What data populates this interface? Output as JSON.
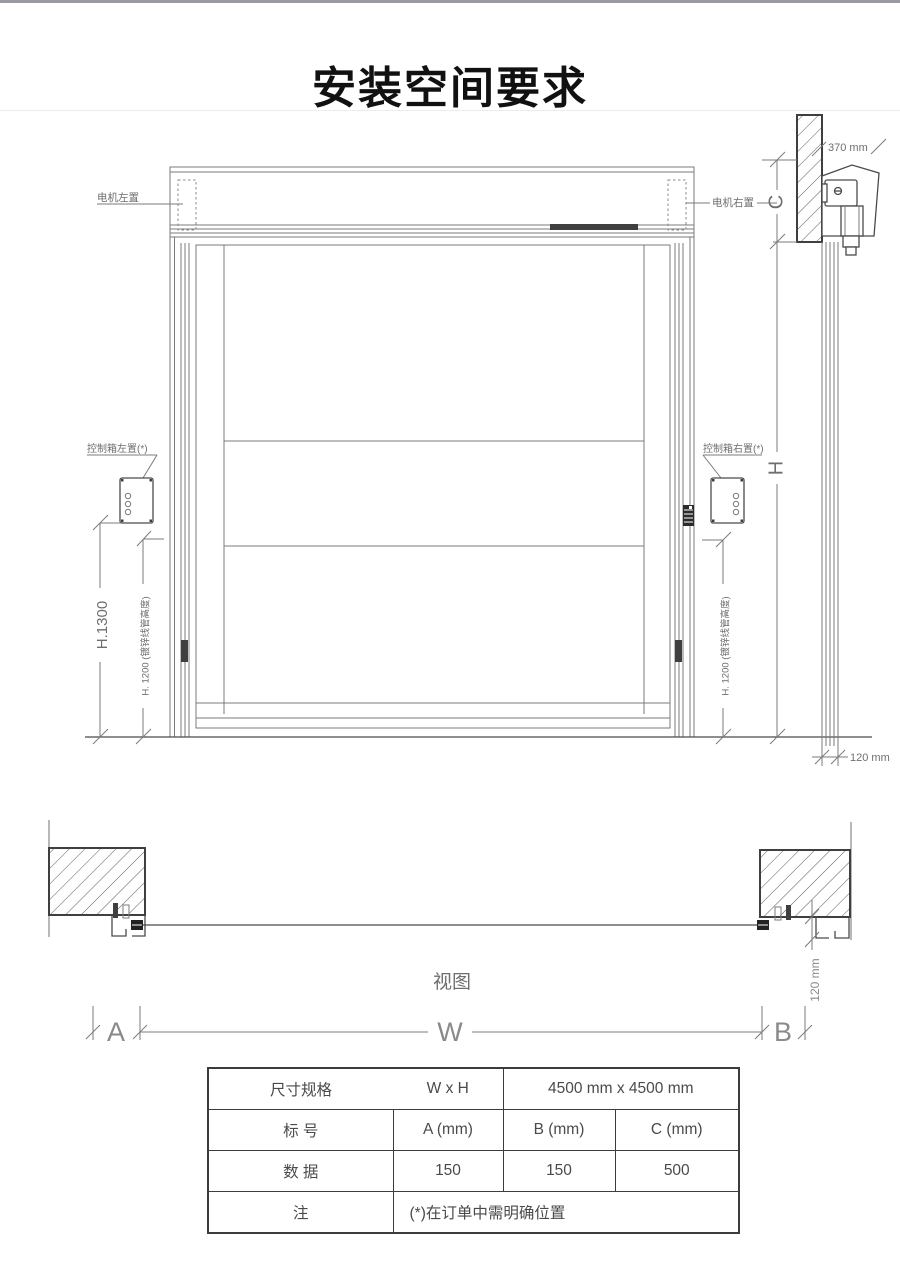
{
  "colors": {
    "topbar": "#9a9aa2",
    "line": "#7b7b7b",
    "line_dark": "#4a4a4a",
    "label_text": "#6e6e6e",
    "title_text": "#111111",
    "table_border": "#3c3c3c",
    "dark_fill": "#3f3f3f"
  },
  "title": "安装空间要求",
  "elevation": {
    "motor_left": "电机左置",
    "motor_right": "电机右置",
    "control_left": "控制箱左置(*)",
    "control_right": "控制箱右置(*)",
    "dim_370mm": "370 mm",
    "dim_c": "C",
    "dim_h": "H",
    "dim_h1300": "H.1300",
    "dim_h1200": "H. 1200 (镀锌线管高度)",
    "dim_120mm": "120 mm"
  },
  "plan": {
    "view_label": "视图",
    "dim_120mm": "120 mm",
    "dim_a": "A",
    "dim_w": "W",
    "dim_b": "B"
  },
  "table": {
    "row1": {
      "c1": "尺寸规格",
      "c2": "W x H",
      "c3": "4500 mm x 4500 mm"
    },
    "row2": {
      "c1": "标 号",
      "c2": "A (mm)",
      "c3": "B (mm)",
      "c4": "C (mm)"
    },
    "row3": {
      "c1": "数 据",
      "c2": "150",
      "c3": "150",
      "c4": "500"
    },
    "row4": {
      "c1": "注",
      "c2": "(*)在订单中需明确位置"
    }
  }
}
